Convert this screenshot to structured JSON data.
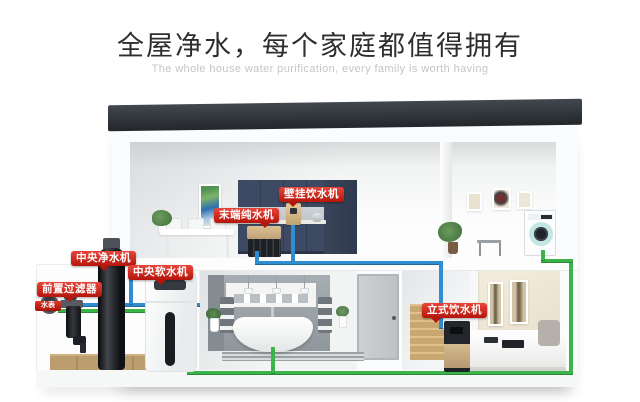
{
  "header": {
    "title": "全屋净水，每个家庭都值得拥有",
    "subtitle": "The whole house water purification, every family is worth having"
  },
  "labels": {
    "wall_dispenser": "壁挂饮水机",
    "terminal_purifier": "末端纯水机",
    "central_purifier": "中央净水机",
    "central_softener": "中央软水机",
    "pre_filter": "前置过滤器",
    "water_meter": "水表",
    "standing_dispenser": "立式饮水机"
  },
  "colors": {
    "label_red": "#c8170c",
    "pipe_blue": "#2f8ed2",
    "pipe_green": "#3bb44a",
    "roof_charcoal": "#32373d",
    "cabinet_navy": "#3e4a63"
  }
}
